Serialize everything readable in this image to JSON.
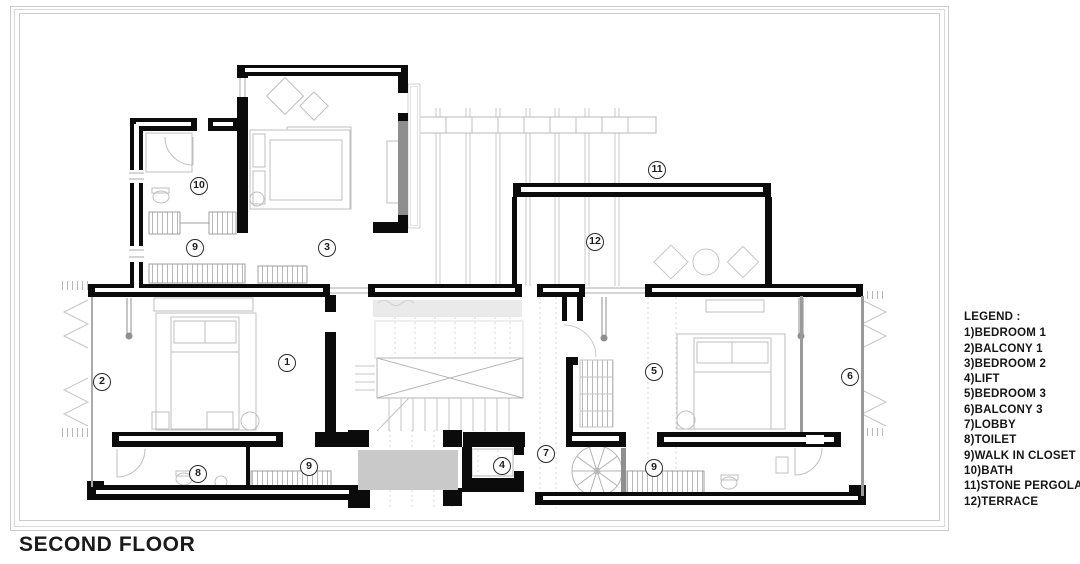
{
  "plan": {
    "title": "SECOND FLOOR"
  },
  "legend": {
    "heading": "LEGEND :",
    "items": [
      "1)BEDROOM 1",
      "2)BALCONY 1",
      "3)BEDROOM 2",
      "4)LIFT",
      "5)BEDROOM 3",
      "6)BALCONY 3",
      "7)LOBBY",
      "8)TOILET",
      "9)WALK IN CLOSET",
      "10)BATH",
      "11)STONE PERGOLA",
      "12)TERRACE"
    ]
  },
  "markers": [
    {
      "label": "10",
      "room": "BATH"
    },
    {
      "label": "9",
      "room": "WALK IN CLOSET"
    },
    {
      "label": "3",
      "room": "BEDROOM 2"
    },
    {
      "label": "11",
      "room": "STONE PERGOLA"
    },
    {
      "label": "12",
      "room": "TERRACE"
    },
    {
      "label": "2",
      "room": "BALCONY 1"
    },
    {
      "label": "1",
      "room": "BEDROOM 1"
    },
    {
      "label": "5",
      "room": "BEDROOM 3"
    },
    {
      "label": "6",
      "room": "BALCONY 3"
    },
    {
      "label": "8",
      "room": "TOILET"
    },
    {
      "label": "9",
      "room": "WALK IN CLOSET"
    },
    {
      "label": "4",
      "room": "LIFT"
    },
    {
      "label": "7",
      "room": "LOBBY"
    },
    {
      "label": "9",
      "room": "WALK IN CLOSET"
    }
  ],
  "palette": {
    "wall": "#0b0b0b",
    "linework": "#bfbfbf",
    "shadow_fill": "#c9c9c9",
    "frame": "#cccccc"
  }
}
